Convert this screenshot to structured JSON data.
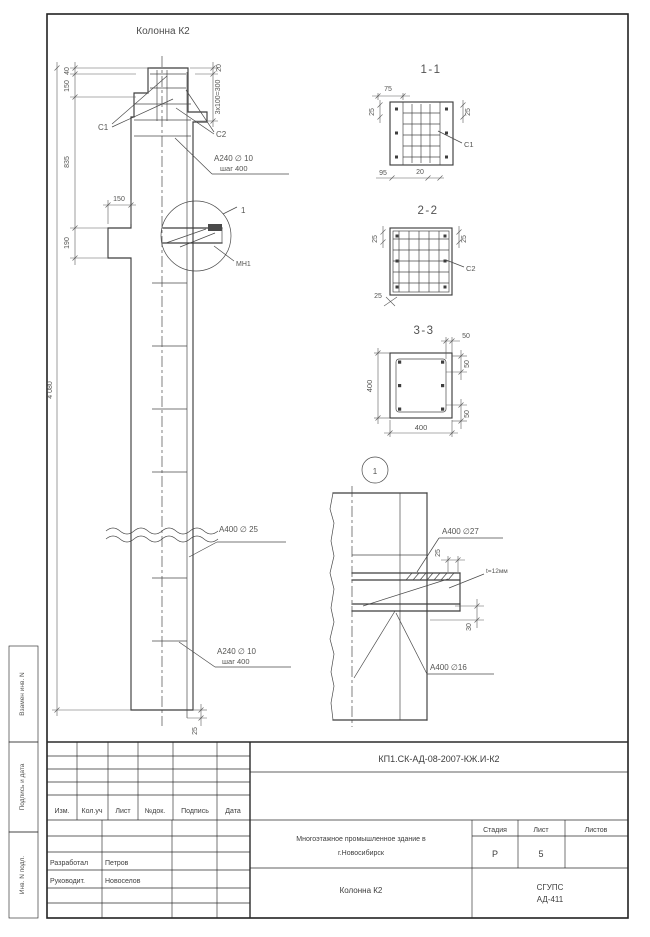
{
  "drawing": {
    "elevation": {
      "title": "Колонна К2",
      "dim_40": "40",
      "dim_150_head": "150",
      "dim_835": "835",
      "dim_190": "190",
      "dim_150_console": "150",
      "dim_total": "4 080",
      "dim_20": "20",
      "dim_3x100": "3x100=300",
      "dim_25_bottom": "25",
      "c1": "С1",
      "c2": "С2",
      "rebar_head": "А240 ∅ 10",
      "rebar_head_step": "шаг 400",
      "rebar_main": "А400 ∅ 25",
      "rebar_low": "А240 ∅ 10",
      "rebar_low_step": "шаг 400",
      "mn1": "МН1",
      "detail_ref": "1"
    },
    "section_1_1": {
      "title": "1-1",
      "d75": "75",
      "d25l": "25",
      "d25r": "25",
      "d95": "95",
      "d20": "20",
      "mesh": "С1"
    },
    "section_2_2": {
      "title": "2-2",
      "d25l": "25",
      "d25r": "25",
      "d25b": "25",
      "mesh": "С2"
    },
    "section_3_3": {
      "title": "3-3",
      "d400l": "400",
      "d400b": "400",
      "d50t": "50",
      "d50rt": "50",
      "d50rb": "50"
    },
    "detail_1": {
      "ref": "1",
      "bar_top": "А400 ∅27",
      "d25": "25",
      "plate": "t=12мм",
      "d30": "30",
      "bar_low": "А400 ∅16"
    }
  },
  "titleblock": {
    "doc_number": "КП1.СК-АД-08-2007-КЖ.И-К2",
    "col_izm": "Изм.",
    "col_koluch": "Кол.уч",
    "col_list": "Лист",
    "col_ndok": "№док.",
    "col_podpis": "Подпись",
    "col_data": "Дата",
    "role_1": "Разработал",
    "name_1": "Петров",
    "role_2": "Руководит.",
    "name_2": "Новоселов",
    "project_line1": "Многоэтажное промышленное здание в",
    "project_line2": "г.Новосибирск",
    "object": "Колонна К2",
    "h_stage": "Стадия",
    "h_sheet": "Лист",
    "h_sheets": "Листов",
    "stage": "Р",
    "sheet": "5",
    "org_1": "СГУПС",
    "org_2": "АД-411"
  },
  "margin_labels": {
    "replace_inv": "Взамен инв. N",
    "sign_date": "Подпись и дата",
    "inv_orig": "Инв. N подл."
  }
}
